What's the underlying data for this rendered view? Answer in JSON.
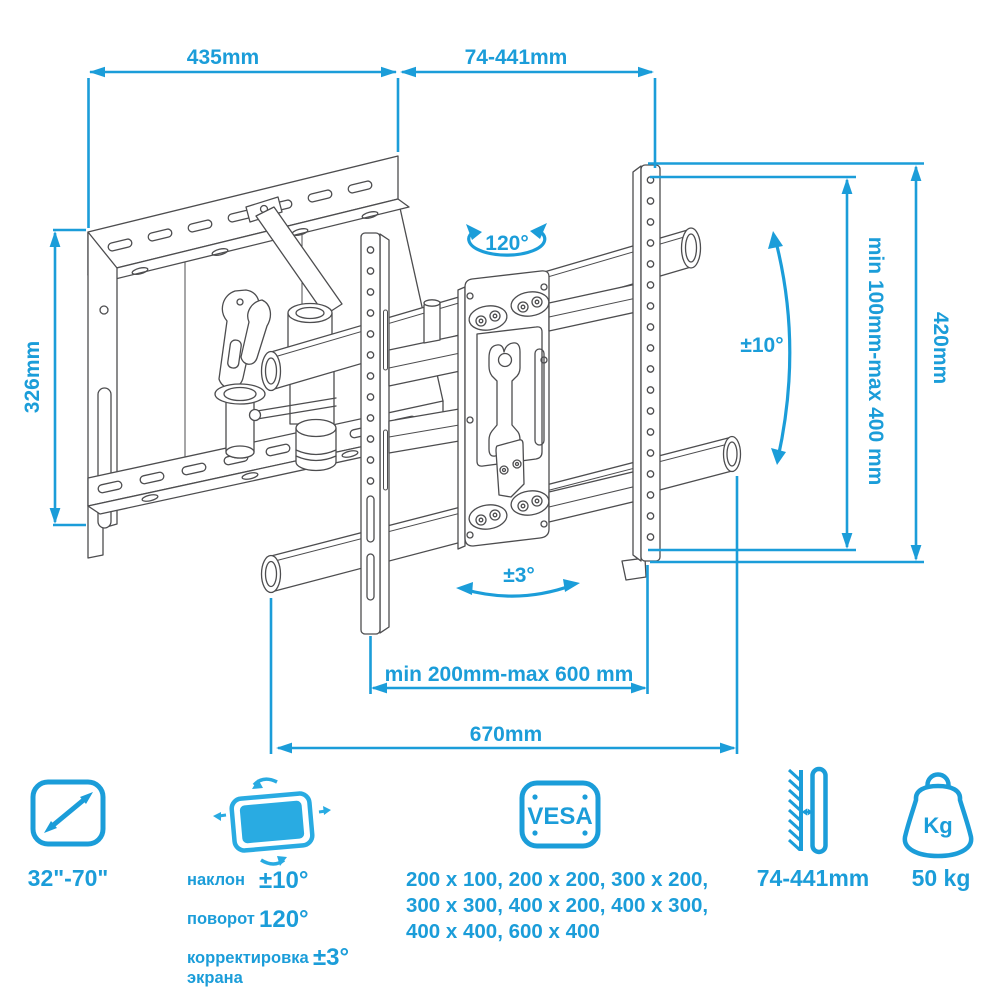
{
  "colors": {
    "accent": "#1B9DD9",
    "screen_fill": "#29ABE2",
    "line_art": "#4d4d4f"
  },
  "dimensions": {
    "top_width": "435mm",
    "arm_extension": "74-441mm",
    "plate_height": "326mm",
    "rail_height": "420mm",
    "vesa_vertical_range": "min 100mm-max 400 mm",
    "tilt": "±10°",
    "swivel": "120°",
    "level_adjust": "±3°",
    "vesa_horizontal_range": "min 200mm-max 600 mm",
    "total_width": "670mm"
  },
  "legend": {
    "screen_size": {
      "value": "32\"-70\""
    },
    "motion": {
      "tilt_label": "наклон",
      "tilt_value": "±10°",
      "swivel_label": "поворот",
      "swivel_value": "120°",
      "adjust_label_line1": "корректировка",
      "adjust_label_line2": "экрана",
      "adjust_value": "±3°"
    },
    "vesa": {
      "badge": "VESA",
      "sizes_lines": [
        "200 x 100, 200 x 200, 300 x 200,",
        "300 x 300, 400 x 200, 400 x 300,",
        "400 x 400, 600 x 400"
      ]
    },
    "wall_distance": {
      "value": "74-441mm"
    },
    "weight": {
      "badge": "Kg",
      "value": "50 kg"
    }
  }
}
